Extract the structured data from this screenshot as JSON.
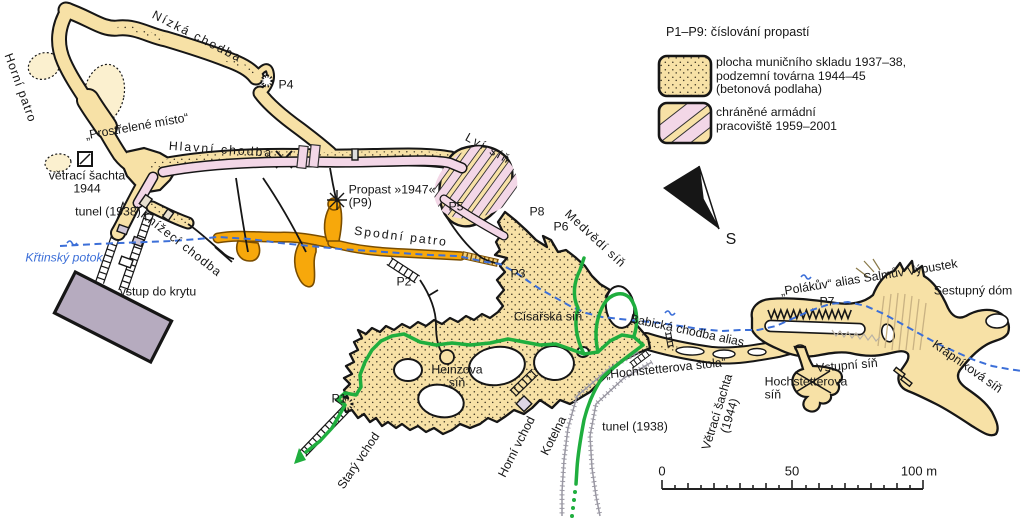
{
  "map_labels": {
    "nizka_chodba": "Nízká chodba",
    "horni_patro": "Horní patro",
    "p4": "P4",
    "prostrelene_misto": "„Prostřelené místo“",
    "hlavni_chodba": "Hlavní chodba",
    "vetraci_sachta_line1": "větrací šachta",
    "vetraci_sachta_line2": "1944",
    "tunel_west": "tunel (1938)",
    "knizeci_chodba": "Knížecí chodba",
    "krtinsky_potok": "Křtinský potok",
    "vstup_do_krytu": "vstup do krytu",
    "propast_line1": "Propast »1947«",
    "propast_line2": "(P9)",
    "spodni_patro": "Spodní patro",
    "p2": "P2",
    "p3": "P3",
    "p5": "P5",
    "p6": "P6",
    "p8": "P8",
    "p1": "P1",
    "p7": "P7",
    "lvi_sin": "Lví síň",
    "medvedi_sin": "Medvědí síň",
    "cisarska_sin": "Císařská síň",
    "babicka_chodba": "Babická chodba alias",
    "hochstetterova_stola": "„Hochstetterova štola“",
    "hochstetterova_sin_line1": "Hochstetterova",
    "hochstetterova_sin_line2": "síň",
    "vetraci_sachta_r_line1": "Větrací šachta",
    "vetraci_sachta_r_line2": "(1944)",
    "vstupni_sin": "Vstupní síň",
    "polakuv": "„Polákův“ alias Salmův Výpustek",
    "sestupny_dom": "Sestupný dóm",
    "krapnikova_sin": "Krápníková síň",
    "tunel_east": "tunel (1938)",
    "heinzova_line1": "Heinzova",
    "heinzova_line2": "síň",
    "stary_vchod": "Starý vchod",
    "horni_vchod": "Horní vchod",
    "kotelna": "Kotelna"
  },
  "legend": {
    "title": "P1–P9:  číslování propastí",
    "items": [
      {
        "lines": [
          "plocha muničního skladu 1937–38,",
          "podzemní továrna 1944–45",
          "(betonová podlaha)"
        ]
      },
      {
        "lines": [
          "chráněné armádní",
          "pracoviště 1959–2001"
        ]
      }
    ]
  },
  "compass": {
    "south_label": "S"
  },
  "scale_bar": {
    "start": "0",
    "middle": "50",
    "end": "100 m"
  },
  "colors": {
    "cave_fill": "#f7e1a6",
    "cave_light": "#fbf0cf",
    "stipple_dot": "#3a3322",
    "lower_floor": "#f7a80b",
    "lower_floor_edge": "#7a4d00",
    "protected": "#f3d7e7",
    "bunker": "#b6abbf",
    "route": "#1fae3e",
    "stream": "#3c6fd8",
    "ink": "#161616",
    "gray_tunnel": "#9a98a3",
    "striation": "#c9b283"
  }
}
